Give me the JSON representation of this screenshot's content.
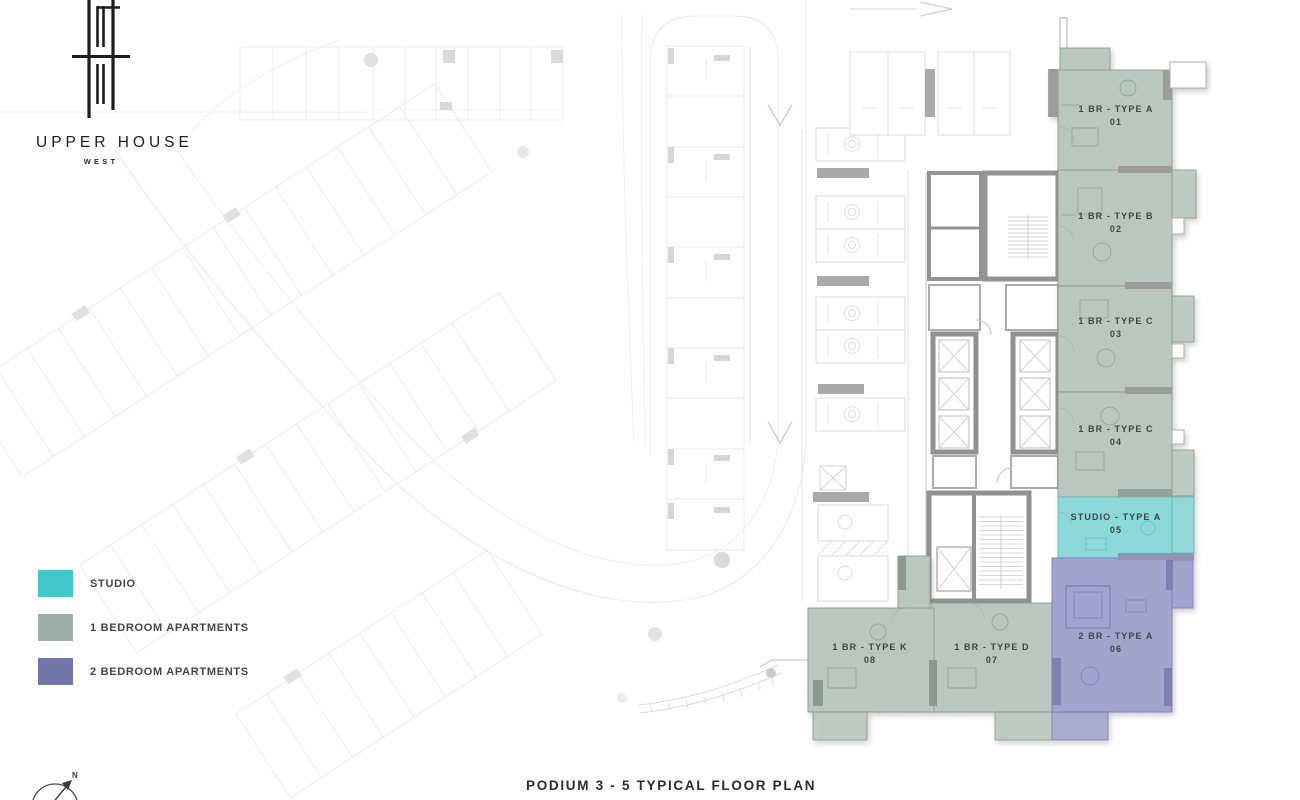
{
  "logo": {
    "title": "UPPER HOUSE",
    "subtitle": "WEST"
  },
  "legend": {
    "items": [
      {
        "label": "STUDIO",
        "color": "#44c7cb",
        "type": "studio"
      },
      {
        "label": "1 BEDROOM APARTMENTS",
        "color": "#9fb0aa",
        "type": "one-bedroom"
      },
      {
        "label": "2 BEDROOM APARTMENTS",
        "color": "#7276a8",
        "type": "two-bedroom"
      }
    ]
  },
  "plan": {
    "caption": "PODIUM 3 - 5 TYPICAL FLOOR PLAN",
    "compass_north_label": "N",
    "units": [
      {
        "name": "1 BR - TYPE A",
        "number": "01",
        "type": "one-bedroom"
      },
      {
        "name": "1 BR - TYPE B",
        "number": "02",
        "type": "one-bedroom"
      },
      {
        "name": "1 BR - TYPE C",
        "number": "03",
        "type": "one-bedroom"
      },
      {
        "name": "1 BR - TYPE C",
        "number": "04",
        "type": "one-bedroom"
      },
      {
        "name": "STUDIO - TYPE A",
        "number": "05",
        "type": "studio"
      },
      {
        "name": "2 BR - TYPE A",
        "number": "06",
        "type": "two-bedroom"
      },
      {
        "name": "1 BR - TYPE D",
        "number": "07",
        "type": "one-bedroom"
      },
      {
        "name": "1 BR - TYPE K",
        "number": "08",
        "type": "one-bedroom"
      }
    ]
  },
  "colors": {
    "studio_swatch": "#44c7cb",
    "one_br_swatch": "#9fb0aa",
    "two_br_swatch": "#7276a8",
    "studio_unit_fill": "#8dd8d8",
    "one_br_unit_fill": "#bac7c1",
    "two_br_unit_fill": "#a2a4cc"
  }
}
